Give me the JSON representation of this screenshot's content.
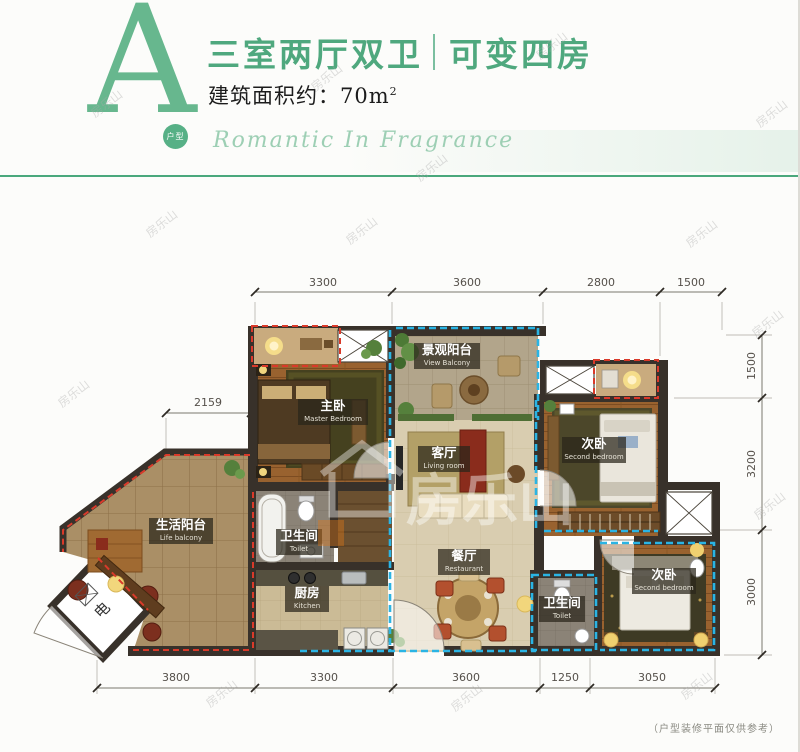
{
  "header": {
    "logo_letter": "A",
    "logo_badge": "户型",
    "title_part1": "三室两厅双卫",
    "title_part2": "可变四房",
    "area_label": "建筑面积约：",
    "area_value": "70m",
    "area_sup": "2",
    "slogan": "Romantic In Fragrance"
  },
  "colors": {
    "brand_green": "#4fa87e",
    "dash_blue": "#2ab4e4",
    "dash_red": "#d93a2a"
  },
  "watermark": {
    "text": "房乐山"
  },
  "plan": {
    "dims": {
      "top": [
        "3300",
        "3600",
        "2800",
        "1500"
      ],
      "right": [
        "1500",
        "3200",
        "3000"
      ],
      "bottom": [
        "3800",
        "3300",
        "3600",
        "1250",
        "3050"
      ],
      "left": [
        "2159"
      ]
    },
    "rooms": {
      "master": {
        "cn": "主卧",
        "en": "Master Bedroom"
      },
      "view_balcony": {
        "cn": "景观阳台",
        "en": "View Balcony"
      },
      "bedroom_right": {
        "cn": "次卧",
        "en": "Second bedroom"
      },
      "living": {
        "cn": "客厅",
        "en": "Living room"
      },
      "life_balcony": {
        "cn": "生活阳台",
        "en": "Life balcony"
      },
      "toilet_top": {
        "cn": "卫生间",
        "en": "Toilet"
      },
      "kitchen": {
        "cn": "厨房",
        "en": "Kitchen"
      },
      "dining": {
        "cn": "餐厅",
        "en": "Restaurant"
      },
      "toilet_bottom": {
        "cn": "卫生间",
        "en": "Toilet"
      },
      "bedroom_bottom": {
        "cn": "次卧",
        "en": "Second bedroom"
      }
    },
    "shaft_label": "电"
  },
  "footer": {
    "note": "（户型装修平面仅供参考）"
  }
}
